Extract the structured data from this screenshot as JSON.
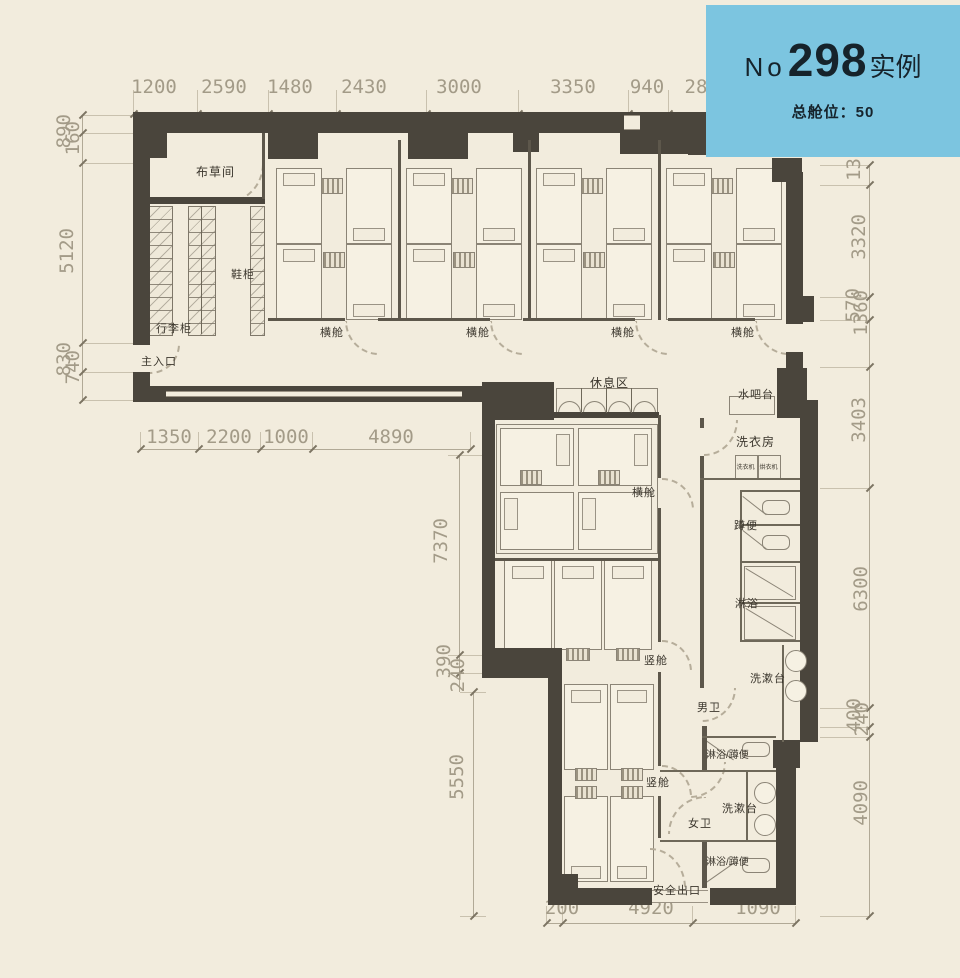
{
  "badge": {
    "prefix": "No",
    "number": "298",
    "suffix": "实例",
    "subtitle": "总舱位：50",
    "bg_color": "#7cc5e0"
  },
  "dims": {
    "top": [
      "1200",
      "2590",
      "1480",
      "2430",
      "3000",
      "3350",
      "940",
      "28"
    ],
    "left": [
      "890",
      "160",
      "5120",
      "830",
      "740"
    ],
    "row2": [
      "1350",
      "2200",
      "1000",
      "4890"
    ],
    "mid": [
      "7370",
      "390",
      "240",
      "5550"
    ],
    "right": [
      "13",
      "3320",
      "570",
      "1360",
      "3403",
      "6300",
      "400",
      "240",
      "4090"
    ],
    "bottom": [
      "200",
      "4920",
      "1090"
    ]
  },
  "labels": {
    "linen": "布草间",
    "shoe": "鞋柜",
    "luggage": "行李柜",
    "entrance": "主入口",
    "hcabin": "横舱",
    "rest": "休息区",
    "waterbar": "水吧台",
    "laundry": "洗衣房",
    "washer": "洗衣机",
    "dryer": "烘衣机",
    "squat": "蹲便",
    "shower": "淋浴",
    "basin": "洗漱台",
    "men": "男卫",
    "women": "女卫",
    "shower_squat": "淋浴/蹲便",
    "vcabin": "竖舱",
    "exit": "安全出口"
  }
}
